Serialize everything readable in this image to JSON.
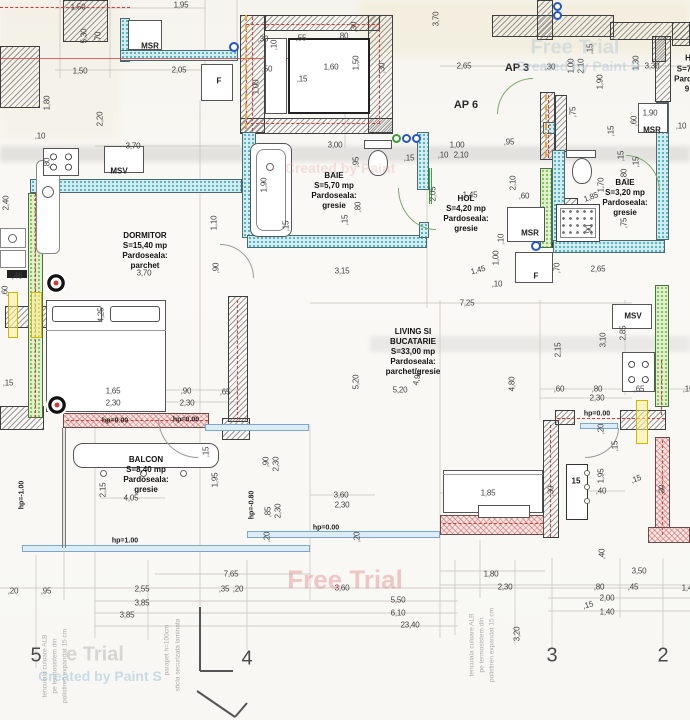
{
  "rooms": [
    {
      "name": "DORMITOR",
      "area": "S=15,40 mp",
      "floor": "Pardoseala: parchet",
      "x": 145,
      "y": 251
    },
    {
      "name": "BAIE",
      "area": "S=5,70 mp",
      "floor": "Pardoseala:\ngresie",
      "x": 334,
      "y": 191
    },
    {
      "name": "HOL",
      "area": "S=4,20 mp",
      "floor": "Pardoseala: gresie",
      "x": 466,
      "y": 214
    },
    {
      "name": "BAIE",
      "area": "S=3,20 mp",
      "floor": "Pardoseala: gresie",
      "x": 625,
      "y": 198
    },
    {
      "name": "LIVING SI BUCATARIE",
      "area": "S=33,00 mp",
      "floor": "Pardoseala: parchet/gresie",
      "x": 413,
      "y": 352
    },
    {
      "name": "BALCON",
      "area": "S=8,40 mp",
      "floor": "Pardoseala: gresie",
      "x": 146,
      "y": 475
    }
  ],
  "labels": [
    {
      "t": "MSR",
      "x": 150,
      "y": 46
    },
    {
      "t": "F",
      "x": 219,
      "y": 81
    },
    {
      "t": "MSV",
      "x": 119,
      "y": 171
    },
    {
      "t": "AP 3",
      "x": 517,
      "y": 68,
      "cls": "big"
    },
    {
      "t": "AP 6",
      "x": 466,
      "y": 105,
      "cls": "big"
    },
    {
      "t": "MSR",
      "x": 530,
      "y": 233
    },
    {
      "t": "F",
      "x": 536,
      "y": 276
    },
    {
      "t": "MSR",
      "x": 652,
      "y": 130
    },
    {
      "t": "MSV",
      "x": 633,
      "y": 316
    },
    {
      "t": "15",
      "x": 576,
      "y": 481
    },
    {
      "t": "hp=0.00",
      "x": 115,
      "y": 421,
      "cls": "hp"
    },
    {
      "t": "hp=0.00",
      "x": 186,
      "y": 420,
      "cls": "hp"
    },
    {
      "t": "hp=0.00",
      "x": 326,
      "y": 528,
      "cls": "hp"
    },
    {
      "t": "hp=0.00",
      "x": 597,
      "y": 414,
      "cls": "hp"
    },
    {
      "t": "hp=1.00",
      "x": 125,
      "y": 541,
      "cls": "hp"
    },
    {
      "t": "hp=-1.00",
      "x": 22,
      "y": 495,
      "cls": "hp",
      "r": -90
    },
    {
      "t": "hp=-0.80",
      "x": 252,
      "y": 505,
      "cls": "hp",
      "r": -90
    },
    {
      "t": "H",
      "x": 688,
      "y": 58
    },
    {
      "t": "S=7",
      "x": 684,
      "y": 69
    },
    {
      "t": "Pard",
      "x": 683,
      "y": 79
    },
    {
      "t": "9",
      "x": 687,
      "y": 89
    }
  ],
  "dims": [
    {
      "t": "1,50",
      "x": 78,
      "y": 7
    },
    {
      "t": "1,95",
      "x": 181,
      "y": 5
    },
    {
      "t": "5,30",
      "x": 84,
      "y": 36,
      "r": -90
    },
    {
      "t": ",70",
      "x": 98,
      "y": 37,
      "r": -90
    },
    {
      "t": "1,50",
      "x": 80,
      "y": 71
    },
    {
      "t": "2,05",
      "x": 179,
      "y": 70
    },
    {
      "t": "1,80",
      "x": 47,
      "y": 103,
      "r": -90
    },
    {
      "t": "2,20",
      "x": 100,
      "y": 119,
      "r": -90
    },
    {
      "t": ",10",
      "x": 40,
      "y": 136
    },
    {
      "t": "3,70",
      "x": 133,
      "y": 146
    },
    {
      "t": ",80",
      "x": 47,
      "y": 163,
      "r": -90
    },
    {
      "t": "2,40",
      "x": 6,
      "y": 203,
      "r": -90
    },
    {
      "t": "1,10",
      "x": 214,
      "y": 223,
      "r": -90
    },
    {
      "t": ",90",
      "x": 216,
      "y": 268,
      "r": -90
    },
    {
      "t": ",46",
      "x": 17,
      "y": 276
    },
    {
      "t": ",60",
      "x": 5,
      "y": 291,
      "r": -90
    },
    {
      "t": "4,25",
      "x": 101,
      "y": 315,
      "r": -90
    },
    {
      "t": "3,70",
      "x": 144,
      "y": 273
    },
    {
      "t": ",15",
      "x": 8,
      "y": 383
    },
    {
      "t": "1,65",
      "x": 113,
      "y": 391
    },
    {
      "t": "2,30",
      "x": 113,
      "y": 403
    },
    {
      "t": ",90",
      "x": 186,
      "y": 391
    },
    {
      "t": "2,30",
      "x": 187,
      "y": 403
    },
    {
      "t": ",65",
      "x": 225,
      "y": 392
    },
    {
      "t": ",55",
      "x": 301,
      "y": 38
    },
    {
      "t": ",80",
      "x": 343,
      "y": 36
    },
    {
      "t": ",30",
      "x": 354,
      "y": 27,
      "r": -90
    },
    {
      "t": ",30",
      "x": 263,
      "y": 39
    },
    {
      "t": ",10",
      "x": 274,
      "y": 45,
      "r": -90
    },
    {
      "t": ",50",
      "x": 267,
      "y": 69
    },
    {
      "t": "1,60",
      "x": 331,
      "y": 67
    },
    {
      "t": "1,50",
      "x": 356,
      "y": 63,
      "r": -90
    },
    {
      "t": ",30",
      "x": 382,
      "y": 68,
      "r": -90
    },
    {
      "t": "1,00",
      "x": 256,
      "y": 87,
      "r": -90
    },
    {
      "t": ",15",
      "x": 302,
      "y": 79
    },
    {
      "t": "3,70",
      "x": 436,
      "y": 19,
      "r": -90
    },
    {
      "t": "3,00",
      "x": 335,
      "y": 145
    },
    {
      "t": "1,00",
      "x": 457,
      "y": 145
    },
    {
      "t": ",10",
      "x": 443,
      "y": 155
    },
    {
      "t": "2,10",
      "x": 461,
      "y": 155
    },
    {
      "t": "2,65",
      "x": 464,
      "y": 66
    },
    {
      "t": ",30",
      "x": 550,
      "y": 67
    },
    {
      "t": "1,00",
      "x": 571,
      "y": 66,
      "r": -90
    },
    {
      "t": "2,10",
      "x": 581,
      "y": 66,
      "r": -90
    },
    {
      "t": ",15",
      "x": 590,
      "y": 49,
      "r": -90
    },
    {
      "t": "1,90",
      "x": 600,
      "y": 82,
      "r": -90
    },
    {
      "t": "1,30",
      "x": 636,
      "y": 63,
      "r": -90
    },
    {
      "t": "3,30",
      "x": 652,
      "y": 66
    },
    {
      "t": ",95",
      "x": 509,
      "y": 142
    },
    {
      "t": ",75",
      "x": 573,
      "y": 112,
      "r": -90
    },
    {
      "t": ",15",
      "x": 611,
      "y": 131,
      "r": -90
    },
    {
      "t": "1,90",
      "x": 650,
      "y": 113
    },
    {
      "t": ",60",
      "x": 634,
      "y": 121,
      "r": -90
    },
    {
      "t": ",10",
      "x": 681,
      "y": 126
    },
    {
      "t": ",15",
      "x": 621,
      "y": 156,
      "r": -90
    },
    {
      "t": "1,70",
      "x": 601,
      "y": 185,
      "r": -90
    },
    {
      "t": "1,85",
      "x": 591,
      "y": 197,
      "r": -20
    },
    {
      "t": ",15",
      "x": 636,
      "y": 162,
      "r": -90
    },
    {
      "t": ",80",
      "x": 624,
      "y": 174,
      "r": -90
    },
    {
      "t": ",75",
      "x": 624,
      "y": 223,
      "r": -90
    },
    {
      "t": ",90",
      "x": 589,
      "y": 230,
      "r": -90
    },
    {
      "t": "2,65",
      "x": 598,
      "y": 269
    },
    {
      "t": ",95",
      "x": 356,
      "y": 162,
      "r": -90
    },
    {
      "t": ",15",
      "x": 409,
      "y": 158
    },
    {
      "t": "1,90",
      "x": 264,
      "y": 185,
      "r": -90
    },
    {
      "t": ",15",
      "x": 286,
      "y": 226,
      "r": -90
    },
    {
      "t": ",80",
      "x": 358,
      "y": 207,
      "r": -90
    },
    {
      "t": ",15",
      "x": 345,
      "y": 220,
      "r": -90
    },
    {
      "t": "2,05",
      "x": 433,
      "y": 194,
      "r": -90
    },
    {
      "t": "3,15",
      "x": 342,
      "y": 271
    },
    {
      "t": "1,45",
      "x": 470,
      "y": 195
    },
    {
      "t": "2,10",
      "x": 513,
      "y": 183,
      "r": -90
    },
    {
      "t": ",60",
      "x": 524,
      "y": 196
    },
    {
      "t": ",10",
      "x": 501,
      "y": 239,
      "r": -90
    },
    {
      "t": "1,00",
      "x": 496,
      "y": 258,
      "r": -90
    },
    {
      "t": "1,45",
      "x": 478,
      "y": 270,
      "r": -15
    },
    {
      "t": ",10",
      "x": 497,
      "y": 284
    },
    {
      "t": ",70",
      "x": 557,
      "y": 268,
      "r": -90
    },
    {
      "t": "7,25",
      "x": 467,
      "y": 303
    },
    {
      "t": "5,20",
      "x": 356,
      "y": 382,
      "r": -90
    },
    {
      "t": "5,20",
      "x": 400,
      "y": 390
    },
    {
      "t": "4,95",
      "x": 417,
      "y": 378,
      "r": -78
    },
    {
      "t": "4,80",
      "x": 512,
      "y": 384,
      "r": -90
    },
    {
      "t": "2,15",
      "x": 558,
      "y": 350,
      "r": -90
    },
    {
      "t": "3,10",
      "x": 603,
      "y": 340,
      "r": -90
    },
    {
      "t": "2,85",
      "x": 623,
      "y": 333,
      "r": -90
    },
    {
      "t": ",60",
      "x": 559,
      "y": 389
    },
    {
      "t": ",80",
      "x": 597,
      "y": 389
    },
    {
      "t": "2,30",
      "x": 597,
      "y": 398
    },
    {
      "t": ",65",
      "x": 639,
      "y": 389
    },
    {
      "t": ",15",
      "x": 688,
      "y": 389
    },
    {
      "t": ",90",
      "x": 266,
      "y": 462,
      "r": -90
    },
    {
      "t": "2,30",
      "x": 276,
      "y": 464,
      "r": -90
    },
    {
      "t": ",15",
      "x": 206,
      "y": 452,
      "r": -90
    },
    {
      "t": "1,95",
      "x": 215,
      "y": 480,
      "r": -90
    },
    {
      "t": ",85",
      "x": 268,
      "y": 512,
      "r": -90
    },
    {
      "t": "2,30",
      "x": 278,
      "y": 511,
      "r": -90
    },
    {
      "t": "3,60",
      "x": 341,
      "y": 495
    },
    {
      "t": "2,30",
      "x": 342,
      "y": 505
    },
    {
      "t": ",20",
      "x": 267,
      "y": 537,
      "r": -90
    },
    {
      "t": ",20",
      "x": 357,
      "y": 537,
      "r": -90
    },
    {
      "t": "2,15",
      "x": 103,
      "y": 490,
      "r": -90
    },
    {
      "t": "4,05",
      "x": 131,
      "y": 498
    },
    {
      "t": "1,95",
      "x": 601,
      "y": 476,
      "r": -90
    },
    {
      "t": ",20",
      "x": 601,
      "y": 429,
      "r": -90
    },
    {
      "t": ",15",
      "x": 615,
      "y": 446,
      "r": -90
    },
    {
      "t": ",40",
      "x": 601,
      "y": 491
    },
    {
      "t": ",15",
      "x": 636,
      "y": 479,
      "r": -20
    },
    {
      "t": ",30",
      "x": 662,
      "y": 490,
      "r": -90
    },
    {
      "t": ",30",
      "x": 551,
      "y": 491,
      "r": -90
    },
    {
      "t": "1,85",
      "x": 488,
      "y": 493
    },
    {
      "t": ",40",
      "x": 602,
      "y": 554,
      "r": -90
    },
    {
      "t": "7,65",
      "x": 231,
      "y": 574
    },
    {
      "t": ",20",
      "x": 13,
      "y": 591
    },
    {
      "t": ",95",
      "x": 46,
      "y": 591
    },
    {
      "t": "2,55",
      "x": 142,
      "y": 589
    },
    {
      "t": ",35",
      "x": 224,
      "y": 589
    },
    {
      "t": ",20",
      "x": 238,
      "y": 589
    },
    {
      "t": "3,60",
      "x": 342,
      "y": 588
    },
    {
      "t": "1,80",
      "x": 491,
      "y": 574
    },
    {
      "t": "3,50",
      "x": 639,
      "y": 571
    },
    {
      "t": "2,30",
      "x": 505,
      "y": 587
    },
    {
      "t": ",80",
      "x": 599,
      "y": 587
    },
    {
      "t": ",45",
      "x": 633,
      "y": 587
    },
    {
      "t": "1,40",
      "x": 689,
      "y": 588
    },
    {
      "t": "2,00",
      "x": 607,
      "y": 598
    },
    {
      "t": ",15",
      "x": 588,
      "y": 605,
      "r": -15
    },
    {
      "t": "1,40",
      "x": 607,
      "y": 612
    },
    {
      "t": "3,85",
      "x": 142,
      "y": 603
    },
    {
      "t": "3,85",
      "x": 127,
      "y": 615
    },
    {
      "t": "5,50",
      "x": 398,
      "y": 600
    },
    {
      "t": "6,10",
      "x": 398,
      "y": 613
    },
    {
      "t": "23,40",
      "x": 410,
      "y": 625
    },
    {
      "t": "3,20",
      "x": 517,
      "y": 634,
      "r": -90
    }
  ],
  "axes": [
    {
      "t": "5",
      "x": 36,
      "y": 656
    },
    {
      "t": "4",
      "x": 247,
      "y": 659
    },
    {
      "t": "3",
      "x": 552,
      "y": 656
    },
    {
      "t": "2",
      "x": 663,
      "y": 656
    }
  ],
  "watermarks": [
    {
      "t": "Free Trial",
      "x": 345,
      "y": 580,
      "s": 26,
      "c": "rgba(225,125,125,0.40)"
    },
    {
      "t": "Free Trial",
      "x": 575,
      "y": 48,
      "s": 20,
      "c": "rgba(160,185,210,0.35)"
    },
    {
      "t": "Created by Paint S",
      "x": 578,
      "y": 66,
      "s": 14,
      "c": "rgba(150,180,210,0.35)"
    },
    {
      "t": "Created by Paint",
      "x": 340,
      "y": 168,
      "s": 14,
      "c": "rgba(225,150,150,0.28)"
    },
    {
      "t": "e Trial",
      "x": 95,
      "y": 655,
      "s": 20,
      "c": "rgba(170,170,170,0.45)"
    },
    {
      "t": "Created by Paint S",
      "x": 100,
      "y": 676,
      "s": 14,
      "c": "rgba(140,185,215,0.45)"
    }
  ],
  "notes": [
    {
      "t": "tencuiala culoare ALB",
      "x": 45,
      "y": 666
    },
    {
      "t": "pe termosistem din",
      "x": 55,
      "y": 666
    },
    {
      "t": "polistiren expandat 15 cm",
      "x": 65,
      "y": 666
    },
    {
      "t": "parapet h=100cm",
      "x": 167,
      "y": 650
    },
    {
      "t": "sticla securizata laminata",
      "x": 178,
      "y": 655
    },
    {
      "t": "tencuiala culoare ALB",
      "x": 472,
      "y": 645
    },
    {
      "t": "pe termosistem din",
      "x": 482,
      "y": 645
    },
    {
      "t": "polistiren expandat 15 cm",
      "x": 492,
      "y": 645
    }
  ],
  "colors": {
    "wall_hatch": "#4a4a4a",
    "insulation_teal": "#2fa3b8",
    "insulation_green": "#66b832",
    "heating_red": "#e23333",
    "gas_orange": "#f2a32f",
    "window_blue": "#7aa7cc"
  }
}
